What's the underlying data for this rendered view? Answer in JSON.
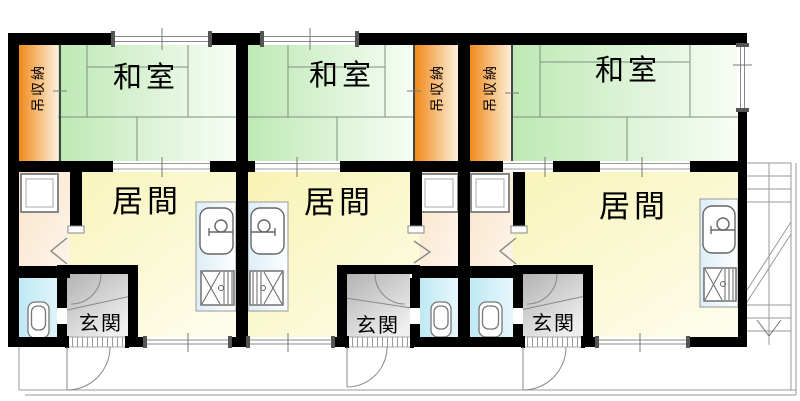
{
  "plan": {
    "title": "三戸一アパート間取り図",
    "units": [
      {
        "name": "unit-1",
        "rooms": {
          "washitsu": "和室",
          "living": "居間",
          "entrance": "玄関",
          "storage": "吊収納"
        }
      },
      {
        "name": "unit-2",
        "rooms": {
          "washitsu": "和室",
          "living": "居間",
          "entrance": "玄関",
          "storage": "吊収納"
        }
      },
      {
        "name": "unit-3",
        "rooms": {
          "washitsu": "和室",
          "living": "居間",
          "entrance": "玄関",
          "storage": "吊収納"
        }
      }
    ],
    "fixtures": [
      "kitchen-sink",
      "gas-stove",
      "toilet",
      "washing-machine-pan",
      "staircase",
      "entrance-door",
      "sliding-window"
    ],
    "colors": {
      "tatami_deep": "#bee9b5",
      "tatami_light": "#f8fdf5",
      "storage_deep": "#f08a1a",
      "storage_light": "#fdf0dd",
      "living_deep": "#f7f3b4",
      "living_light": "#fefdee",
      "utility_deep": "#fae3c8",
      "utility_light": "#fdf5ea",
      "bath_deep": "#bfe9f4",
      "bath_light": "#e6f7fc",
      "entrance_deep": "#b3b3b3",
      "entrance_light": "#efefef",
      "counter_deep": "#ddeef7",
      "counter_light": "#fdfefe",
      "wall": "#000000",
      "thin_line": "#888888"
    }
  }
}
